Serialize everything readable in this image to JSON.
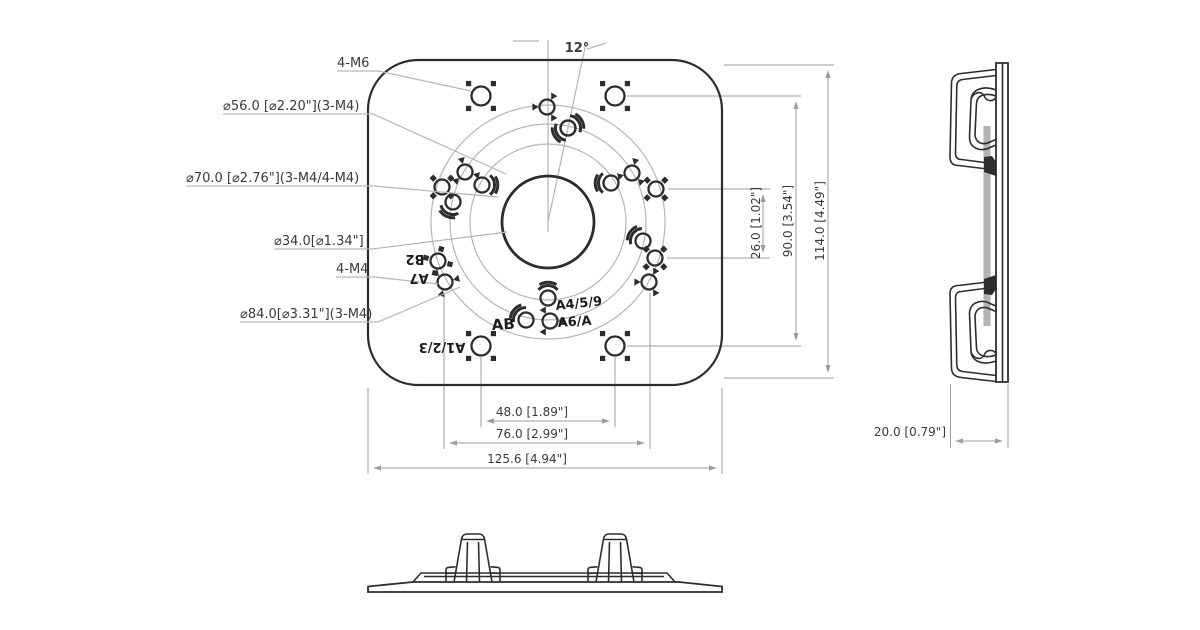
{
  "colors": {
    "ink": "#2d2d2d",
    "gline": "#b6b6b6",
    "gdim": "#9d9d9d",
    "txt": "#3b3b3b",
    "eng": "#1c1c1c",
    "bg": "#ffffff"
  },
  "front_view": {
    "angle_label": "12°",
    "callouts": {
      "m6": "4-M6",
      "d56": "⌀56.0 [⌀2.20\"](3-M4)",
      "d70": "⌀70.0 [⌀2.76\"](3-M4/4-M4)",
      "d34": "⌀34.0[⌀1.34\"]",
      "m4": "4-M4",
      "d84": "⌀84.0[⌀3.31\"](3-M4)"
    },
    "engravings": {
      "b2": "B2",
      "a7": "A7",
      "ab": "AB",
      "a123": "A1/2/3",
      "a459": "A4/5/9",
      "a6a": "A6/A"
    },
    "dims": {
      "width_inner": "48.0 [1.89\"]",
      "width_mid": "76.0 [2.99\"]",
      "width_outer": "125.6 [4.94\"]",
      "height_inner": "26.0 [1.02\"]",
      "height_mid": "90.0 [3.54\"]",
      "height_outer": "114.0 [4.49\"]"
    }
  },
  "side_view": {
    "dims": {
      "depth": "20.0 [0.79\"]"
    }
  }
}
